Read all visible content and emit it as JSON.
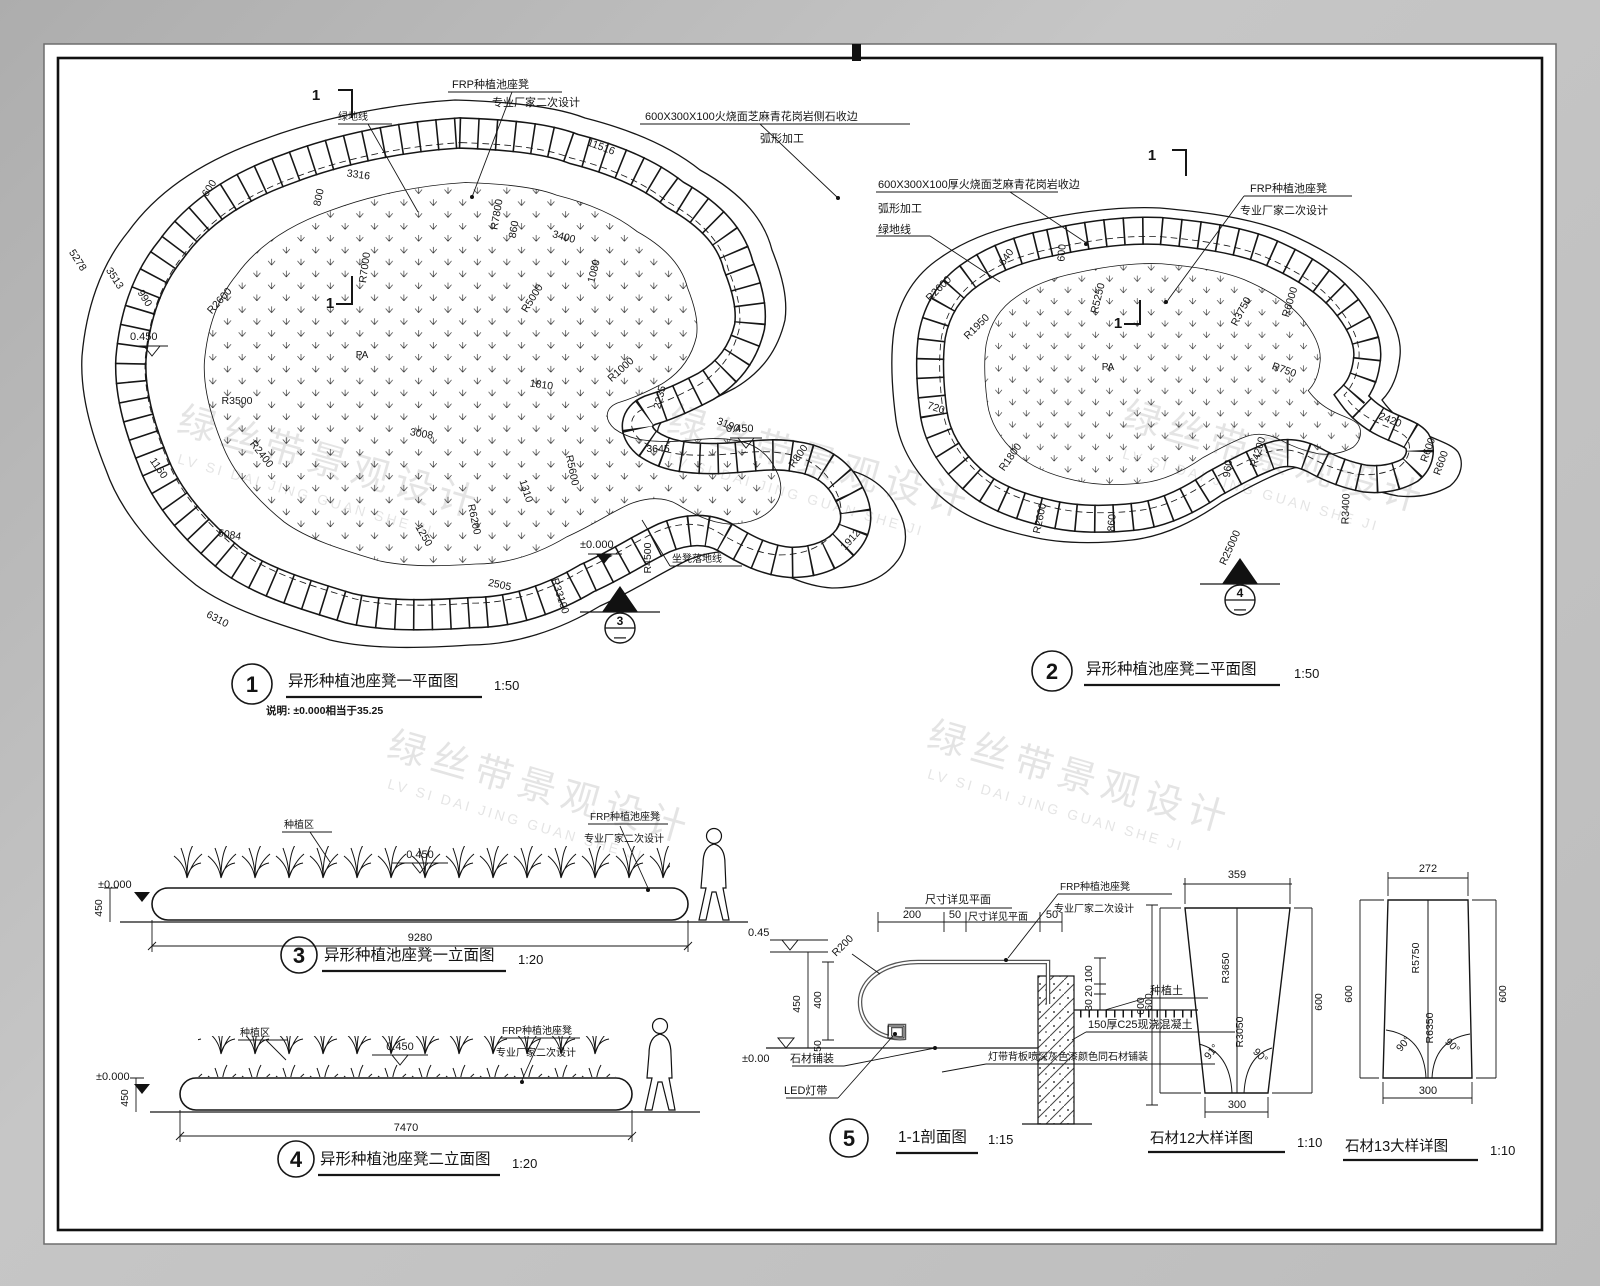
{
  "watermark": {
    "cn": "绿丝带景观设计",
    "en": "LV SI DAI JING GUAN SHE JI"
  },
  "plan1": {
    "no": "1",
    "title": "异形种植池座凳一平面图",
    "scale": "1:50",
    "note": "说明: ±0.000相当于35.25",
    "pa": "PA",
    "cut": "1",
    "bubble": "3",
    "bubble_dash": "—",
    "callouts": {
      "frp1": "FRP种植池座凳",
      "frp2": "专业厂家二次设计",
      "stone1": "600X300X100火烧面芝麻青花岗岩侧石收边",
      "stone2": "弧形加工",
      "green": "绿地线",
      "seat": "坐凳落地线"
    },
    "levels": {
      "l1": "0.450",
      "l2": "0.450",
      "l3": "±0.000"
    },
    "dims": [
      "5278",
      "3513",
      "990",
      "600",
      "3316",
      "800",
      "11516",
      "R7800",
      "860",
      "3400",
      "1080",
      "R7000",
      "R2600",
      "R5000",
      "R3500",
      "R1000",
      "1810",
      "2235",
      "3190",
      "3645",
      "3008",
      "R800",
      "1160",
      "R2400",
      "5084",
      "R6200",
      "1250",
      "1310",
      "R5600",
      "2505",
      "6310",
      "R33100",
      "R4500",
      "1912"
    ]
  },
  "plan2": {
    "no": "2",
    "title": "异形种植池座凳二平面图",
    "scale": "1:50",
    "pa": "PA",
    "cut": "1",
    "bubble": "4",
    "bubble_dash": "—",
    "callouts": {
      "stone1": "600X300X100厚火烧面芝麻青花岗岩收边",
      "stone2": "弧形加工",
      "green": "绿地线",
      "frp1": "FRP种植池座凳",
      "frp2": "专业厂家二次设计"
    },
    "dims": [
      "640",
      "600",
      "R5250",
      "R2600",
      "R1950",
      "R3750",
      "R6000",
      "R750",
      "2420",
      "R600",
      "R600",
      "720",
      "R1800",
      "R2600",
      "860",
      "960",
      "R4200",
      "R25000",
      "R3400"
    ]
  },
  "elev1": {
    "no": "3",
    "title": "异形种植池座凳一立面图",
    "scale": "1:20",
    "len": "9280",
    "h": "450",
    "lv_top": "0.450",
    "lv_base": "±0.000",
    "plant": "种植区",
    "frp1": "FRP种植池座凳",
    "frp2": "专业厂家二次设计"
  },
  "elev2": {
    "no": "4",
    "title": "异形种植池座凳二立面图",
    "scale": "1:20",
    "len": "7470",
    "h": "450",
    "lv_top": "0.450",
    "lv_base": "±0.000",
    "plant": "种植区",
    "frp1": "FRP种植池座凳",
    "frp2": "专业厂家二次设计"
  },
  "section": {
    "no": "5",
    "title": "1-1剖面图",
    "scale": "1:15",
    "ref1": "尺寸详见平面",
    "ref2": "尺寸详见平面",
    "d200": "200",
    "d50a": "50",
    "d50b": "50",
    "v100": "100",
    "v20": "20",
    "v30": "30",
    "h450": "450",
    "h400": "400",
    "h50": "50",
    "r200": "R200",
    "right600": "600",
    "lv_top": "0.45",
    "lv_base": "±0.00",
    "frp1": "FRP种植池座凳",
    "frp2": "专业厂家二次设计",
    "soil": "种植土",
    "concrete": "150厚C25现浇混凝土",
    "backboard": "灯带背板喷深灰色漆颜色同石材铺装",
    "paving": "石材铺装",
    "led": "LED灯带"
  },
  "stone12": {
    "title": "石材12大样详图",
    "scale": "1:10",
    "top": "359",
    "bottom": "300",
    "left": "600",
    "right": "600",
    "r1": "R3650",
    "r2": "R3050",
    "a1": "91°",
    "a2": "90°"
  },
  "stone13": {
    "title": "石材13大样详图",
    "scale": "1:10",
    "top": "272",
    "bottom": "300",
    "left": "600",
    "right": "600",
    "r1": "R5750",
    "r2": "R6350",
    "a1": "90°",
    "a2": "90°"
  }
}
